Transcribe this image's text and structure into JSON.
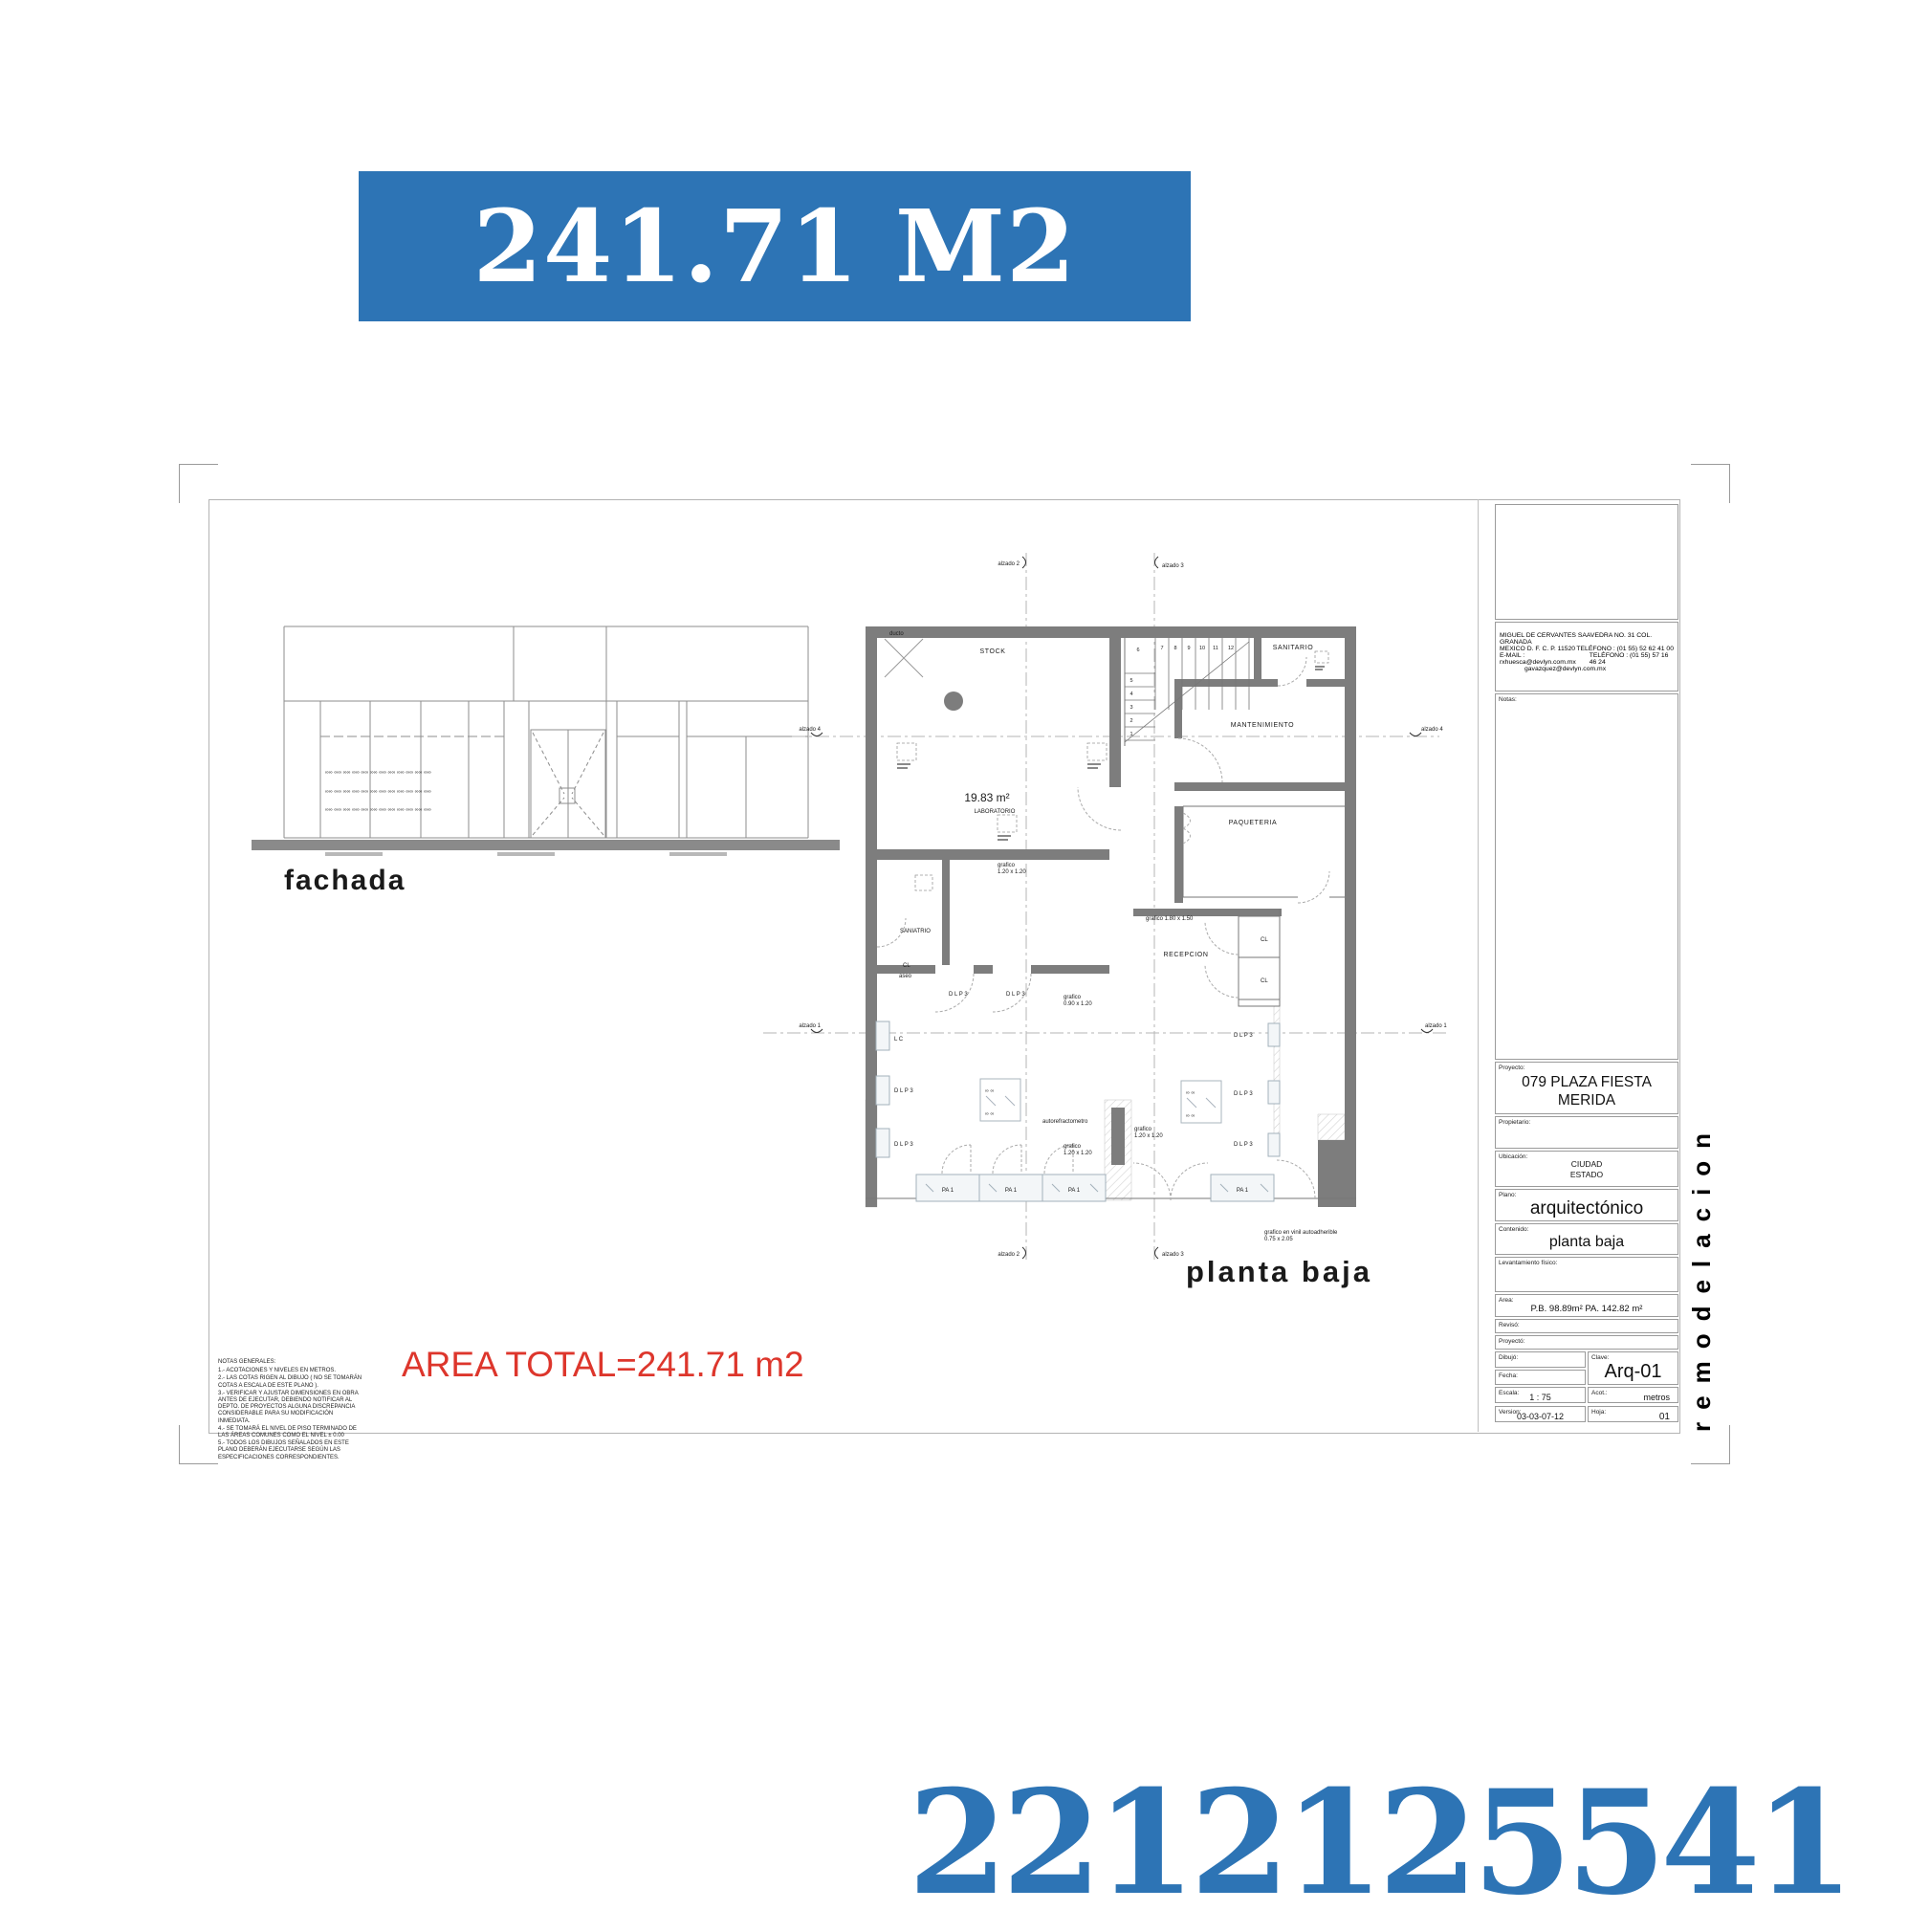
{
  "banner": {
    "text": "241.71 M2"
  },
  "footer_number": "2212125541",
  "area_total": "AREA TOTAL=241.71 m2",
  "side_label": "remodelacion",
  "colors": {
    "accent_blue": "#2d74b5",
    "note_red": "#dd362c",
    "wall_gray": "#7d7d7d"
  },
  "general_notes": {
    "title": "NOTAS GENERALES:",
    "items": [
      "1.-  ACOTACIONES Y NIVELES EN METROS.",
      "2.-  LAS COTAS RIGEN AL DIBUJO ( NO SE TOMARÁN COTAS A ESCALA DE ESTE PLANO ).",
      "3.-  VERIFICAR Y AJUSTAR DIMENSIONES EN OBRA ANTES DE EJECUTAR, DEBIENDO NOTIFICAR AL DEPTO. DE PROYECTOS ALGUNA DISCREPANCIA CONSIDERABLE PARA SU MODIFICACIÓN INMEDIATA.",
      "4.-  SE TOMARÁ EL NIVEL DE PISO TERMINADO DE LAS ÁREAS COMUNES COMO EL NIVEL ± 0.00",
      "5.-  TODOS LOS DIBUJOS SEÑALADOS EN ESTE PLANO DEBERÁN EJECUTARSE SEGÚN LAS ESPECIFICACIONES CORRESPONDIENTES."
    ]
  },
  "fachada": {
    "title": "fachada",
    "glasses": "∞∞  ∞∞  ∞∞  ∞∞    ∞∞  ∞∞  ∞∞  ∞∞    ∞∞  ∞∞  ∞∞  ∞∞"
  },
  "plan": {
    "title": "planta baja",
    "rooms": {
      "stock": "STOCK",
      "ducto": "ducto",
      "lab_area": "19.83 m²",
      "laboratorio": "LABORATORIO",
      "sanitario": "SANITARIO",
      "mantenimiento": "MANTENIMIENTO",
      "paqueteria": "PAQUETERIA",
      "saniatrio": "SANIATRIO",
      "aseo": "aseo",
      "recepcion": "RECEPCION",
      "autorefractometro": "autorefractometro"
    },
    "labels": {
      "dlp3": "D L P 3",
      "pa1": "PA 1",
      "cl": "CL",
      "lc": "L C"
    },
    "graficos": {
      "g120": "grafico",
      "g120_size": "1.20 x 1.20",
      "g090": "grafico",
      "g090_size": "0.90 x 1.20",
      "g180": "grafico 1.80 x 1.50",
      "vinil": "grafico en vinil autoadherible",
      "vinil_size": "0.75 x 2.05",
      "glasses_pair": "∞  ∞"
    },
    "axes": {
      "a1": "alzado 1",
      "a2": "alzado 2",
      "a3": "alzado 3",
      "a4": "alzado 4"
    },
    "stair": [
      "1",
      "2",
      "3",
      "4",
      "5",
      "6",
      "7",
      "8",
      "9",
      "10",
      "11",
      "12"
    ]
  },
  "titleblock": {
    "address": {
      "line1": "MIGUEL DE CERVANTES SAAVEDRA NO. 31 COL. GRANADA",
      "line2_left": "MEXICO D. F.  C. P. 11520",
      "line2_right": "TELÉFONO : (01 55) 52 62 41 00",
      "line3_left": "E-MAIL : rxhuesca@devlyn.com.mx",
      "line3_right": "TELÉFONO : (01 55) 57 16 46 24",
      "line4": "gavazquez@devlyn.com.mx"
    },
    "notas_label": "Notas:",
    "proyecto_label": "Proyecto:",
    "proyecto": "079 PLAZA FIESTA MERIDA",
    "propietario_label": "Propietario:",
    "ubicacion_label": "Ubicación:",
    "ubicacion_line1": "CIUDAD",
    "ubicacion_line2": "ESTADO",
    "plano_label": "Plano:",
    "plano": "arquitectónico",
    "contenido_label": "Contenido:",
    "contenido": "planta baja",
    "levantamiento_label": "Levantamiento físico:",
    "area_label": "Area:",
    "area": "P.B. 98.89m² PA. 142.82 m²",
    "reviso_label": "Revisó:",
    "proyecto2_label": "Proyectó:",
    "dibujo_label": "Dibujó:",
    "fecha_label": "Fecha:",
    "clave_label": "Clave:",
    "clave": "Arq-01",
    "escala_label": "Escala:",
    "escala": "1 : 75",
    "acot_label": "Acot.:",
    "acot": "metros",
    "version_label": "Version:",
    "version": "03-03-07-12",
    "hoja_label": "Hoja:",
    "hoja": "01"
  }
}
